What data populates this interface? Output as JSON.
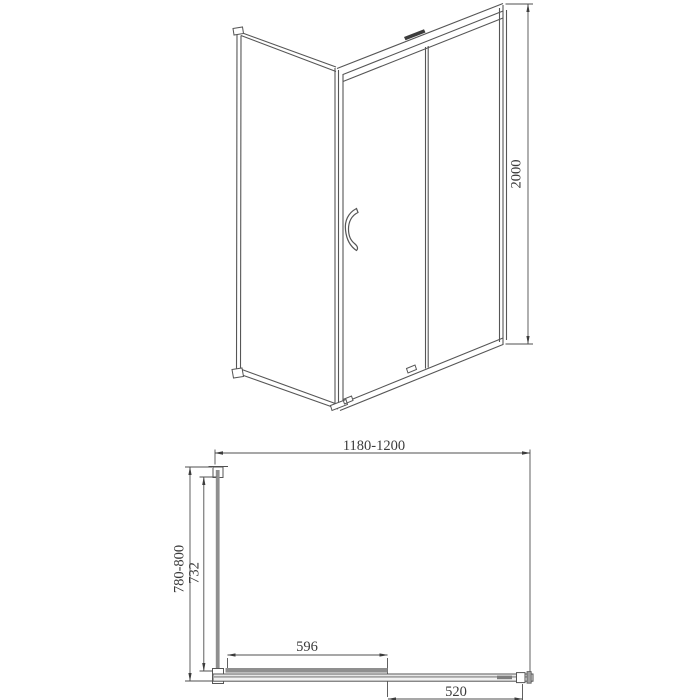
{
  "drawing": {
    "kind": "shower-enclosure-technical-drawing",
    "dims": {
      "height": "2000",
      "width_range": "1180-1200",
      "depth_range": "780-800",
      "glass_depth": "732",
      "door_panel_width": "596",
      "fixed_panel_width": "520"
    },
    "colors": {
      "line": "#4f4f4f",
      "panel_gray": "#8f8f8f",
      "text": "#3c3c3c",
      "background": "#ffffff"
    }
  }
}
